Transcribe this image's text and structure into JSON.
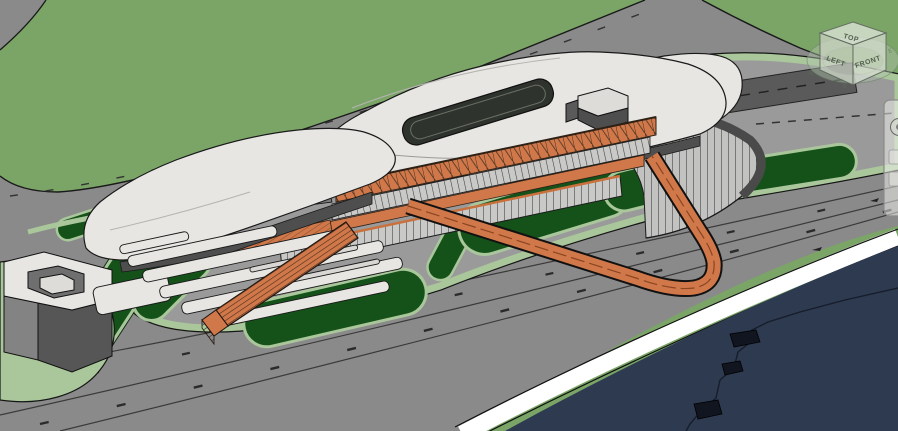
{
  "app": {
    "type": "bim-3d-viewport",
    "description": "3D shaded view of a waterfront terminal building site"
  },
  "viewcube": {
    "top": "TOP",
    "left": "LEFT",
    "front": "FRONT",
    "compass": [
      "W",
      "S",
      "E"
    ]
  },
  "navigation_bar": {
    "visible": true,
    "position": "right-edge-partial"
  },
  "palette": {
    "grass": "#7aa567",
    "road": "#8a8a8a",
    "plaza": "#9a9a9a",
    "site_border": "#a9c79b",
    "lawn": "#15521a",
    "water": "#2e3a50",
    "quay": "#ffffff",
    "roof": "#e7e6e3",
    "roof_shadow": "#bcbbb8",
    "wall_dark": "#4e4e4e",
    "wall_mid": "#808080",
    "glazing": "#c9c9c7",
    "orange": "#d0784a",
    "orange_dark": "#8a4520",
    "dark_lane": "#5a5a5a",
    "outline": "#1a1a1a"
  },
  "scene": {
    "elements": [
      "terminal-west-roof",
      "terminal-main-roof",
      "terminal-east-roof",
      "roof-skylight",
      "penthouse-block",
      "curved-podium",
      "concourse-truss-band",
      "concourse-glazing-band",
      "concourse-deck",
      "ground-colonnade",
      "bus-canopies",
      "grand-stair",
      "loop-ramp",
      "office-building",
      "lawns",
      "site-plaza",
      "perimeter-road",
      "waterfront-road",
      "quay-edge",
      "water",
      "shoreline-contour"
    ]
  }
}
